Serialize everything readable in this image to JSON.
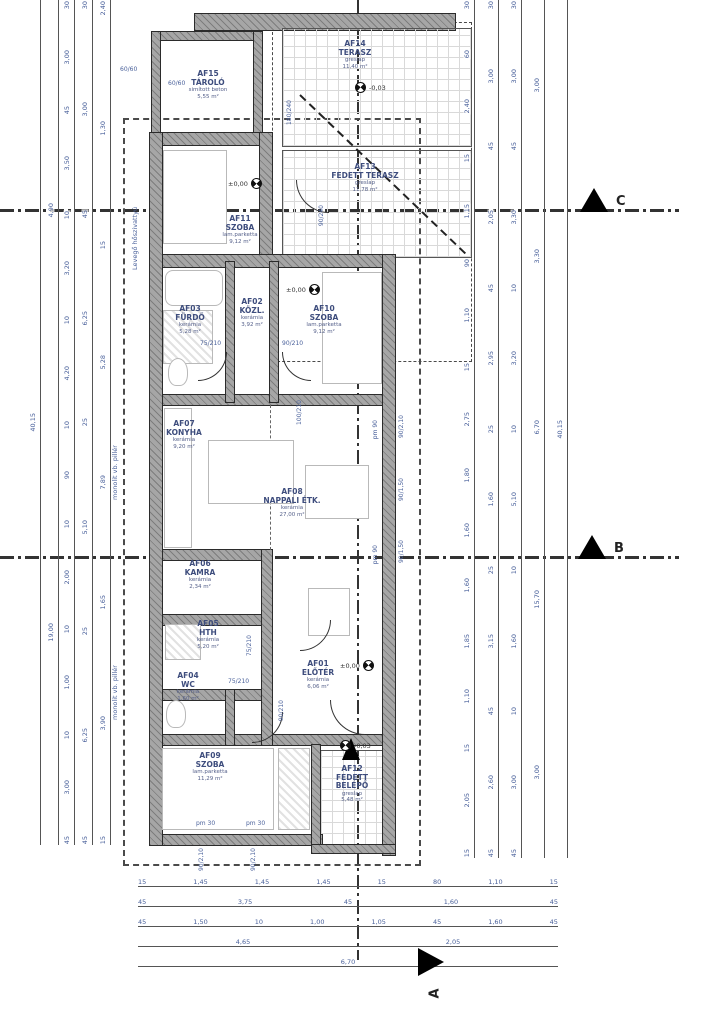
{
  "rooms": {
    "af01": {
      "id": "AF01",
      "name": "ELŐTÉR",
      "finish": "kerámia",
      "area": "6,06 m²"
    },
    "af02": {
      "id": "AF02",
      "name": "KÖZL.",
      "finish": "kerámia",
      "area": "3,92 m²"
    },
    "af03": {
      "id": "AF03",
      "name": "FÜRDŐ",
      "finish": "kerámia",
      "area": "5,28 m²"
    },
    "af04": {
      "id": "AF04",
      "name": "WC",
      "finish": "kerámia",
      "area": "1,60 m²"
    },
    "af05": {
      "id": "AF05",
      "name": "HTH",
      "finish": "kerámia",
      "area": "5,20 m²"
    },
    "af06": {
      "id": "AF06",
      "name": "KAMRA",
      "finish": "kerámia",
      "area": "2,34 m²"
    },
    "af07": {
      "id": "AF07",
      "name": "KONYHA",
      "finish": "kerámia",
      "area": "9,20 m²"
    },
    "af08": {
      "id": "AF08",
      "name": "NAPPALI ÉTK.",
      "finish": "kerámia",
      "area": "27,00 m²"
    },
    "af09": {
      "id": "AF09",
      "name": "SZOBA",
      "finish": "lam.parketta",
      "area": "11,29 m²"
    },
    "af10": {
      "id": "AF10",
      "name": "SZOBA",
      "finish": "lam.parketta",
      "area": "9,12 m²"
    },
    "af11": {
      "id": "AF11",
      "name": "SZOBA",
      "finish": "lam.parketta",
      "area": "9,12 m²"
    },
    "af12": {
      "id": "AF12",
      "name": "FEDETT BELÉPŐ",
      "finish": "greslap",
      "area": "5,48 m²"
    },
    "af13": {
      "id": "AF13",
      "name": "FEDETT TERASZ",
      "finish": "greslap",
      "area": "11,78 m²"
    },
    "af14": {
      "id": "AF14",
      "name": "TERASZ",
      "finish": "greslap",
      "area": "11,40 m²"
    },
    "af15": {
      "id": "AF15",
      "name": "TÁROLÓ",
      "finish": "simított beton",
      "area": "5,55 m²"
    }
  },
  "levels": {
    "zero": "±0,00",
    "minus": "-0,03"
  },
  "sections": {
    "a": "A",
    "b": "B",
    "c": "C"
  },
  "annotations": {
    "heat_pump": "Levegő hőszivattyú",
    "pillar": "monolit vb. pillér",
    "pillar_size": "60/60"
  },
  "doors": [
    "90/240",
    "75/210",
    "90/210",
    "100/210",
    "75/210",
    "75/210",
    "180/240",
    "90/210"
  ],
  "windows": {
    "right": [
      "90/2,10",
      "90/1,50",
      "90/1,50"
    ],
    "bottom": [
      "90/2,10",
      "90/2,10"
    ],
    "pm": [
      "pm 90",
      "pm 90",
      "pm 30",
      "pm 30"
    ]
  },
  "dims": {
    "left_cols": [
      [
        "40,15"
      ],
      [
        "4,90",
        "19,00"
      ],
      [
        "30",
        "3,00",
        "45",
        "3,50",
        "10",
        "3,20",
        "10",
        "4,20",
        "10",
        "90",
        "10",
        "2,00",
        "10",
        "1,00",
        "10",
        "3,00",
        "45"
      ],
      [
        "30",
        "3,00",
        "45",
        "6,25",
        "25",
        "5,10",
        "25",
        "6,25",
        "45"
      ],
      [
        "2,40",
        "1,30",
        "15",
        "5,28",
        "7,89",
        "1,65",
        "3,90",
        "15"
      ]
    ],
    "right_cols": [
      [
        "30",
        "60",
        "2,40",
        "15",
        "1,15",
        "90",
        "1,10",
        "15",
        "2,75",
        "1,80",
        "1,60",
        "1,60",
        "1,85",
        "1,10",
        "15",
        "2,05",
        "15"
      ],
      [
        "30",
        "3,00",
        "45",
        "2,05",
        "45",
        "2,95",
        "25",
        "1,60",
        "25",
        "3,15",
        "45",
        "2,60",
        "45"
      ],
      [
        "30",
        "3,00",
        "45",
        "3,30",
        "10",
        "3,20",
        "10",
        "5,10",
        "10",
        "1,60",
        "10",
        "3,00",
        "45"
      ],
      [
        "3,00",
        "3,30",
        "6,70",
        "15,70",
        "3,00"
      ],
      [
        "40,15"
      ]
    ],
    "bottom_rows": [
      [
        "15",
        "1,45",
        "1,45",
        "1,45",
        "15",
        "80",
        "1,10",
        "15"
      ],
      [
        "45",
        "3,75",
        "45",
        "1,60",
        "45"
      ],
      [
        "45",
        "1,50",
        "10",
        "1,00",
        "1,05",
        "45",
        "1,60",
        "45"
      ],
      [
        "4,65",
        "2,05"
      ],
      [
        "6,70"
      ]
    ]
  }
}
